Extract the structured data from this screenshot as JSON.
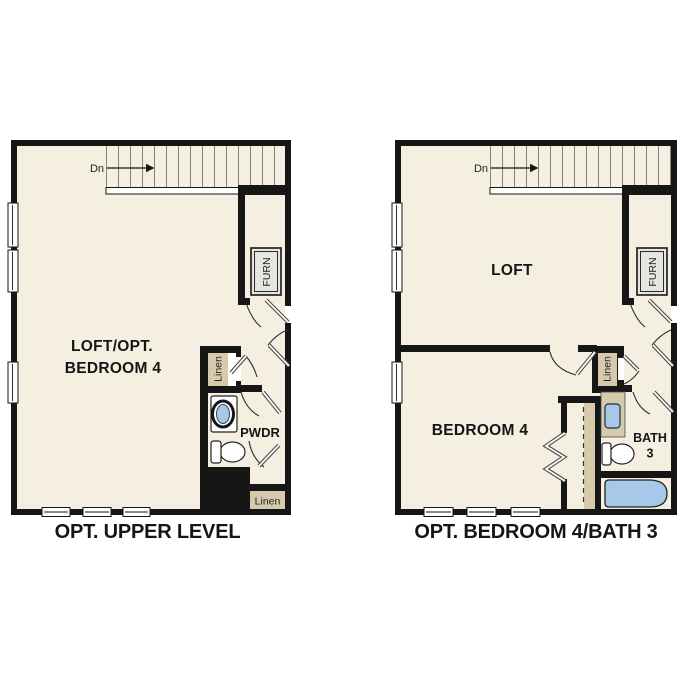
{
  "colors": {
    "floor": "#F5EFE2",
    "walls": "#161616",
    "cabinetry_tan": "#D6C9AC",
    "plumbing_blue": "#A7C9E9",
    "furnace_fill": "#E6E6E1"
  },
  "plan_left": {
    "caption": "OPT. UPPER LEVEL",
    "room_label_line1": "LOFT/OPT.",
    "room_label_line2": "BEDROOM 4",
    "stairs_label": "Dn",
    "furnace_label": "FURN",
    "linen_closet_label": "Linen",
    "powder_room_label": "PWDR",
    "linen_lower_label": "Linen"
  },
  "plan_right": {
    "caption": "OPT. BEDROOM 4/BATH 3",
    "loft_label": "LOFT",
    "bedroom_label": "BEDROOM 4",
    "stairs_label": "Dn",
    "furnace_label": "FURN",
    "linen_closet_label": "Linen",
    "bath_label_line1": "BATH",
    "bath_label_line2": "3"
  }
}
